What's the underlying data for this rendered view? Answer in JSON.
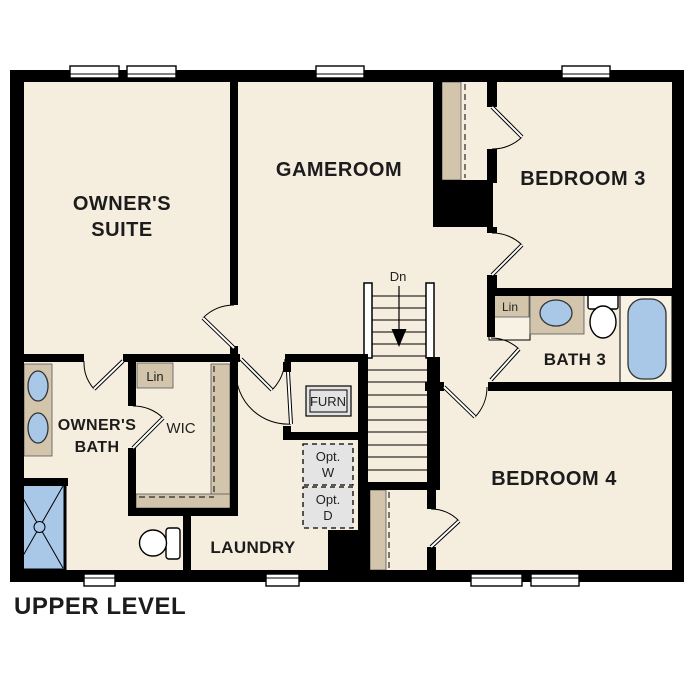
{
  "floorplan": {
    "title": "UPPER LEVEL",
    "rooms": {
      "owners_suite_line1": "OWNER'S",
      "owners_suite_line2": "SUITE",
      "gameroom": "GAMEROOM",
      "bedroom3": "BEDROOM 3",
      "bedroom4": "BEDROOM 4",
      "bath3": "BATH 3",
      "owners_bath_line1": "OWNER'S",
      "owners_bath_line2": "BATH",
      "wic": "WIC",
      "laundry": "LAUNDRY"
    },
    "annotations": {
      "stair_direction": "Dn",
      "linen_wic": "Lin",
      "linen_bath3": "Lin",
      "furnace": "FURN",
      "opt_washer_line1": "Opt.",
      "opt_washer_line2": "W",
      "opt_dryer_line1": "Opt.",
      "opt_dryer_line2": "D"
    },
    "colors": {
      "floor": "#f5edde",
      "wall": "#000000",
      "casework_tan": "#d2c5ab",
      "fixture_blue": "#a9c8e8",
      "optional_gray": "#e4e4e4",
      "text": "#1c1c1c"
    }
  }
}
